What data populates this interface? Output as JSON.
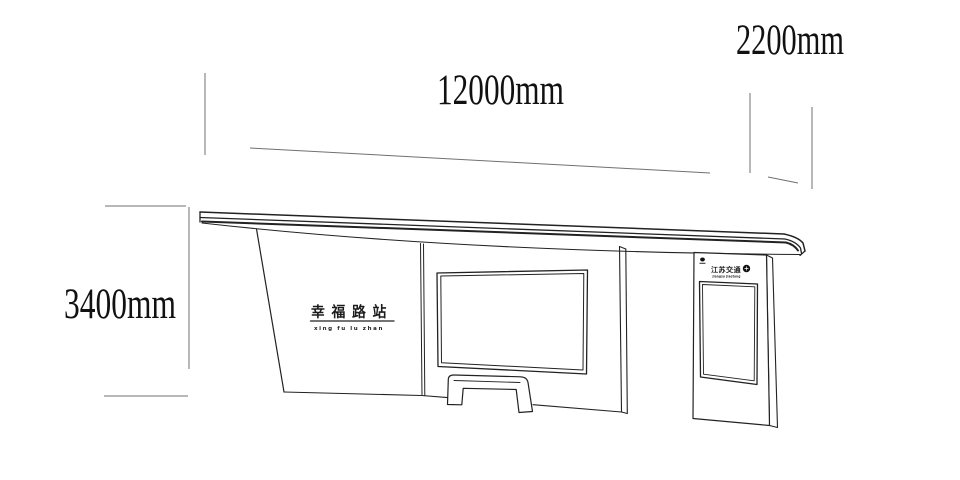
{
  "drawing_title": "bus shelter elevation",
  "dimensions": {
    "width": "12000mm",
    "canopy_depth": "2200mm",
    "height": "3400mm"
  },
  "station_sign": {
    "name_zh": "幸福路站",
    "name_pinyin": "xing fu lu zhan"
  },
  "kiosk": {
    "brand_zh": "江苏交通",
    "brand_sub": "jiangsu jiaotong"
  },
  "icons": {
    "kiosk_brand_logo": "dark-roundel-logo",
    "kiosk_top_mark": "small-emblem-icon"
  },
  "colors": {
    "background": "#ffffff",
    "outline": "#222222",
    "dimension_lines": "#707070",
    "label_text": "#111111"
  }
}
